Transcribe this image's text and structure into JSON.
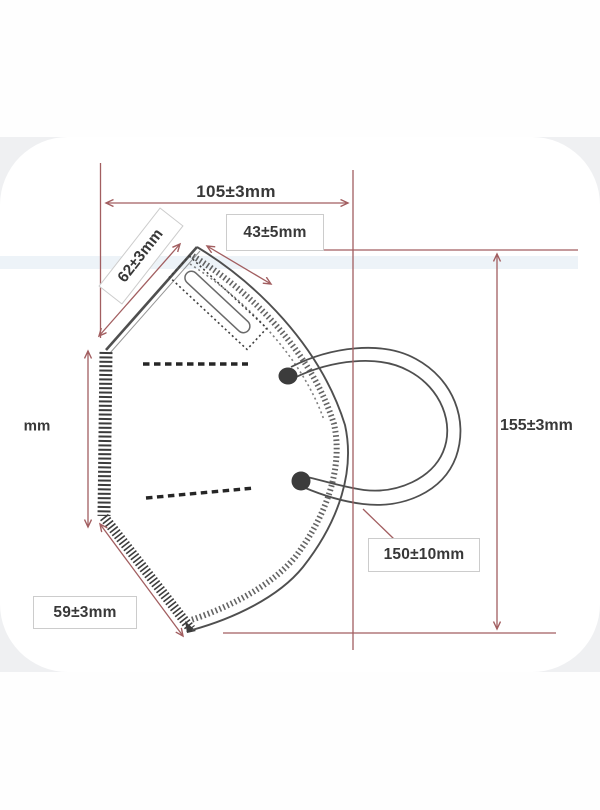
{
  "page": {
    "background": "#fefefe",
    "photo_band_background": "#eff0f2",
    "card_background": "#ffffff"
  },
  "diagram": {
    "type": "technical-drawing",
    "subject": "folded protective face mask with ear loop and nose strip",
    "dimensions": [
      {
        "id": "top-width",
        "label": "105±3mm"
      },
      {
        "id": "nose-strip-length",
        "label": "43±5mm"
      },
      {
        "id": "upper-left-edge",
        "label": "62±3mm"
      },
      {
        "id": "left-edge-height-partial",
        "label": "mm"
      },
      {
        "id": "overall-height",
        "label": "155±3mm"
      },
      {
        "id": "ear-loop-length",
        "label": "150±10mm"
      },
      {
        "id": "lower-left-edge",
        "label": "59±3mm"
      }
    ],
    "colors": {
      "dimension_lines": "#a25e60",
      "drawing_lines": "#4f4f4f",
      "label_text": "#383838",
      "label_box_border": "#cccccc",
      "label_box_background": "#ffffff"
    }
  }
}
